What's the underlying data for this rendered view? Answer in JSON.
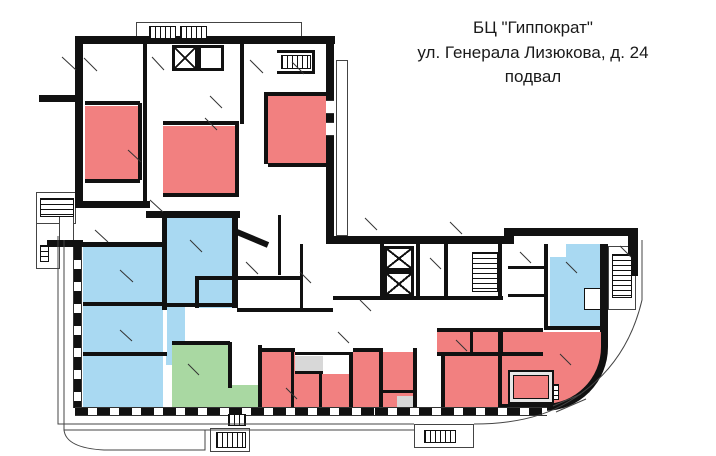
{
  "title": {
    "line1": "БЦ \"Гиппократ\"",
    "line2": "ул. Генерала Лизюкова, д. 24",
    "line3": "подвал"
  },
  "legend_colors": {
    "wall": "#111111",
    "room_red": "#f28080",
    "room_blue": "#a9d9f2",
    "room_green": "#a9d8a2",
    "room_gray": "#d8d8d8",
    "room_white": "#ffffff",
    "outline": "#444444"
  },
  "floor_plan": {
    "canvas": {
      "width": 716,
      "height": 456
    },
    "rooms": [
      {
        "n": "office-upper-1",
        "c": "red",
        "x": 85,
        "y": 106,
        "w": 53,
        "h": 73
      },
      {
        "n": "office-upper-2",
        "c": "red",
        "x": 163,
        "y": 126,
        "w": 72,
        "h": 67
      },
      {
        "n": "office-upper-3",
        "c": "red",
        "x": 268,
        "y": 96,
        "w": 62,
        "h": 67
      },
      {
        "n": "room-strip",
        "c": "red",
        "x": 437,
        "y": 332,
        "w": 106,
        "h": 20
      },
      {
        "n": "room-block",
        "c": "red",
        "x": 445,
        "y": 356,
        "w": 57,
        "h": 52
      },
      {
        "n": "room-l1",
        "c": "red",
        "x": 262,
        "y": 352,
        "w": 33,
        "h": 56
      },
      {
        "n": "room-l2",
        "c": "red",
        "x": 295,
        "y": 374,
        "w": 88,
        "h": 34
      },
      {
        "n": "room-l2b",
        "c": "red",
        "x": 353,
        "y": 352,
        "w": 30,
        "h": 22
      },
      {
        "n": "room-l3",
        "c": "red",
        "x": 383,
        "y": 352,
        "w": 30,
        "h": 56
      },
      {
        "n": "hall-curved",
        "c": "red",
        "x": 502,
        "y": 332,
        "w": 106,
        "h": 79,
        "curved": true
      },
      {
        "n": "room-blue-tall",
        "c": "blue",
        "x": 167,
        "y": 218,
        "w": 65,
        "h": 85
      },
      {
        "n": "room-blue-a",
        "c": "blue",
        "x": 83,
        "y": 247,
        "w": 80,
        "h": 55
      },
      {
        "n": "room-blue-b",
        "c": "blue",
        "x": 83,
        "y": 306,
        "w": 80,
        "h": 46
      },
      {
        "n": "room-blue-c",
        "c": "blue",
        "x": 83,
        "y": 356,
        "w": 80,
        "h": 52
      },
      {
        "n": "room-blue-small",
        "c": "blue",
        "x": 199,
        "y": 280,
        "w": 33,
        "h": 28
      },
      {
        "n": "room-blue-col",
        "c": "blue",
        "x": 167,
        "y": 306,
        "w": 18,
        "h": 46
      },
      {
        "n": "room-blue-colb",
        "c": "blue",
        "x": 166,
        "y": 352,
        "w": 14,
        "h": 13
      },
      {
        "n": "room-blue-right",
        "c": "blue",
        "x": 550,
        "y": 244,
        "w": 52,
        "h": 82
      },
      {
        "n": "notch-1",
        "c": "white",
        "x": 550,
        "y": 244,
        "w": 16,
        "h": 13
      },
      {
        "n": "notch-2",
        "c": "white",
        "x": 584,
        "y": 288,
        "w": 17,
        "h": 22,
        "bordered": true
      },
      {
        "n": "room-green",
        "c": "green",
        "x": 172,
        "y": 345,
        "w": 56,
        "h": 63
      },
      {
        "n": "vestibule-green",
        "c": "green",
        "x": 228,
        "y": 385,
        "w": 30,
        "h": 30
      },
      {
        "n": "store-gray-1",
        "c": "gray",
        "x": 295,
        "y": 356,
        "w": 28,
        "h": 16
      },
      {
        "n": "store-gray-2",
        "c": "gray",
        "x": 397,
        "y": 396,
        "w": 16,
        "h": 13
      }
    ],
    "walls": [
      [
        75,
        36,
        260,
        8
      ],
      [
        75,
        36,
        8,
        172
      ],
      [
        39,
        95,
        38,
        7
      ],
      [
        326,
        44,
        8,
        200
      ],
      [
        75,
        201,
        75,
        7
      ],
      [
        146,
        211,
        94,
        7
      ],
      [
        47,
        240,
        36,
        7
      ],
      [
        333,
        236,
        175,
        8
      ],
      [
        504,
        228,
        10,
        16
      ],
      [
        508,
        228,
        126,
        8
      ],
      [
        628,
        228,
        10,
        48
      ],
      [
        600,
        244,
        8,
        88
      ],
      [
        162,
        215,
        5,
        95
      ],
      [
        232,
        215,
        6,
        93
      ],
      [
        83,
        242,
        84,
        5
      ],
      [
        83,
        302,
        84,
        4
      ],
      [
        83,
        352,
        84,
        4
      ],
      [
        167,
        303,
        71,
        4
      ],
      [
        228,
        342,
        4,
        46
      ],
      [
        172,
        341,
        58,
        4
      ],
      [
        199,
        276,
        33,
        4
      ],
      [
        195,
        276,
        4,
        32
      ],
      [
        380,
        244,
        4,
        52
      ],
      [
        416,
        244,
        4,
        52
      ],
      [
        444,
        244,
        4,
        52
      ],
      [
        498,
        244,
        4,
        52
      ],
      [
        333,
        296,
        170,
        4
      ],
      [
        237,
        308,
        96,
        4
      ],
      [
        278,
        215,
        3,
        60
      ],
      [
        300,
        244,
        3,
        64
      ],
      [
        237,
        276,
        66,
        4
      ],
      [
        544,
        244,
        4,
        84
      ],
      [
        508,
        266,
        38,
        3
      ],
      [
        508,
        294,
        38,
        3
      ],
      [
        544,
        326,
        60,
        4
      ],
      [
        498,
        332,
        4,
        78
      ],
      [
        258,
        345,
        4,
        63
      ],
      [
        258,
        348,
        37,
        4
      ],
      [
        291,
        352,
        3,
        56
      ],
      [
        295,
        352,
        58,
        3
      ],
      [
        295,
        371,
        28,
        3
      ],
      [
        319,
        374,
        3,
        34
      ],
      [
        349,
        352,
        4,
        56
      ],
      [
        353,
        348,
        30,
        4
      ],
      [
        379,
        352,
        4,
        56
      ],
      [
        413,
        348,
        4,
        60
      ],
      [
        441,
        352,
        4,
        56
      ],
      [
        383,
        390,
        30,
        3
      ],
      [
        437,
        328,
        106,
        4
      ],
      [
        437,
        352,
        106,
        4
      ],
      [
        470,
        332,
        3,
        20
      ],
      [
        500,
        332,
        3,
        20
      ],
      [
        138,
        103,
        4,
        77
      ],
      [
        85,
        101,
        55,
        4
      ],
      [
        85,
        179,
        55,
        4
      ],
      [
        143,
        44,
        4,
        160
      ],
      [
        163,
        121,
        74,
        4
      ],
      [
        235,
        121,
        4,
        74
      ],
      [
        163,
        193,
        76,
        4
      ],
      [
        264,
        92,
        4,
        72
      ],
      [
        268,
        92,
        62,
        4
      ],
      [
        268,
        163,
        62,
        4
      ],
      [
        240,
        44,
        4,
        80
      ],
      [
        277,
        50,
        38,
        3
      ],
      [
        277,
        71,
        38,
        3
      ],
      [
        312,
        50,
        3,
        24
      ]
    ],
    "window_walls": [
      {
        "t": "v",
        "x": 73,
        "y": 247,
        "w": 9,
        "h": 161
      },
      {
        "t": "h",
        "x": 75,
        "y": 407,
        "w": 300,
        "h": 9
      },
      {
        "t": "h",
        "x": 375,
        "y": 407,
        "w": 172,
        "h": 9
      }
    ],
    "window_gaps": [
      [
        326,
        100,
        8,
        14
      ],
      [
        326,
        122,
        8,
        14
      ]
    ],
    "outlines": [
      [
        136,
        22,
        166,
        22
      ],
      [
        36,
        192,
        40,
        32
      ],
      [
        36,
        223,
        24,
        46
      ],
      [
        608,
        246,
        28,
        64
      ],
      [
        414,
        424,
        60,
        24
      ],
      [
        210,
        428,
        40,
        24
      ],
      [
        336,
        60,
        12,
        176
      ],
      [
        59,
        208,
        15,
        39
      ]
    ],
    "stairs": [
      {
        "t": "h",
        "x": 149,
        "y": 26,
        "w": 27,
        "h": 13
      },
      {
        "t": "h",
        "x": 180,
        "y": 26,
        "w": 27,
        "h": 13
      },
      {
        "t": "h",
        "x": 281,
        "y": 55,
        "w": 30,
        "h": 14
      },
      {
        "t": "v",
        "x": 40,
        "y": 198,
        "w": 34,
        "h": 19
      },
      {
        "t": "v",
        "x": 40,
        "y": 245,
        "w": 9,
        "h": 17
      },
      {
        "t": "v",
        "x": 472,
        "y": 252,
        "w": 26,
        "h": 40
      },
      {
        "t": "v",
        "x": 612,
        "y": 254,
        "w": 20,
        "h": 44
      },
      {
        "t": "h",
        "x": 424,
        "y": 430,
        "w": 32,
        "h": 13
      },
      {
        "t": "h",
        "x": 216,
        "y": 432,
        "w": 30,
        "h": 16
      },
      {
        "t": "h",
        "x": 228,
        "y": 414,
        "w": 18,
        "h": 12
      },
      {
        "t": "v",
        "x": 552,
        "y": 384,
        "w": 7,
        "h": 16
      }
    ],
    "shafts": [
      {
        "x": 384,
        "y": 246,
        "w": 30,
        "h": 25,
        "cross": true
      },
      {
        "x": 384,
        "y": 271,
        "w": 30,
        "h": 26,
        "cross": true
      },
      {
        "x": 172,
        "y": 45,
        "w": 26,
        "h": 26,
        "cross": true
      },
      {
        "x": 198,
        "y": 45,
        "w": 26,
        "h": 26,
        "cross": false
      }
    ],
    "equipment": [
      {
        "n": "equipment-pad",
        "x": 508,
        "y": 370,
        "w": 46,
        "h": 34
      }
    ],
    "door_lines": [
      [
        62,
        57,
        76,
        70
      ],
      [
        84,
        58,
        97,
        71
      ],
      [
        152,
        57,
        164,
        70
      ],
      [
        250,
        60,
        263,
        73
      ],
      [
        292,
        62,
        304,
        74
      ],
      [
        210,
        96,
        222,
        108
      ],
      [
        128,
        150,
        141,
        162
      ],
      [
        205,
        118,
        217,
        130
      ],
      [
        150,
        200,
        163,
        212
      ],
      [
        95,
        230,
        108,
        242
      ],
      [
        246,
        262,
        258,
        274
      ],
      [
        300,
        272,
        311,
        283
      ],
      [
        360,
        300,
        371,
        311
      ],
      [
        430,
        258,
        441,
        269
      ],
      [
        520,
        252,
        531,
        263
      ],
      [
        566,
        262,
        577,
        273
      ],
      [
        188,
        364,
        199,
        375
      ],
      [
        286,
        388,
        297,
        399
      ],
      [
        338,
        332,
        349,
        343
      ],
      [
        456,
        340,
        467,
        351
      ],
      [
        560,
        354,
        571,
        365
      ],
      [
        620,
        246,
        631,
        257
      ],
      [
        120,
        270,
        133,
        282
      ],
      [
        120,
        330,
        132,
        341
      ],
      [
        190,
        240,
        202,
        252
      ],
      [
        365,
        218,
        377,
        230
      ],
      [
        450,
        222,
        462,
        234
      ]
    ],
    "thin_paths": [
      "M58,236 L58,424 L414,424",
      "M64,240 L64,430 L414,430",
      "M474,424 Q532,424 568,402 Q626,368 642,300 L642,240",
      "M64,430 Q66,448 104,450 L205,450 L205,430",
      "M556,412 L586,399",
      "M553,406 L581,394"
    ],
    "thick_lines": [
      [
        237,
        232,
        268,
        245
      ]
    ]
  }
}
